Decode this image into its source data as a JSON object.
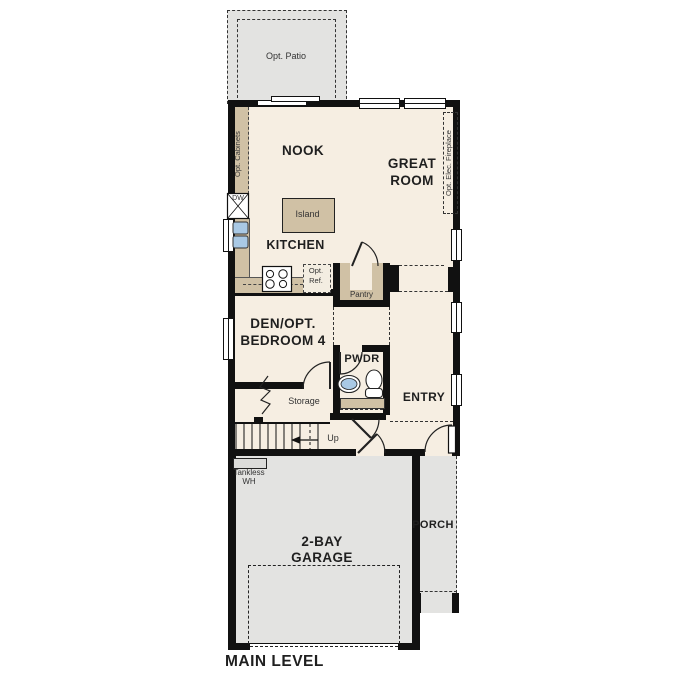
{
  "plan_title": "MAIN LEVEL",
  "rooms": {
    "nook": "NOOK",
    "great_room": [
      "GREAT",
      "ROOM"
    ],
    "kitchen": "KITCHEN",
    "den": [
      "DEN/OPT.",
      "BEDROOM 4"
    ],
    "powder": "PWDR",
    "entry": "ENTRY",
    "storage": "Storage",
    "pantry": "Pantry",
    "garage": [
      "2-BAY",
      "GARAGE"
    ],
    "porch": "PORCH"
  },
  "features": {
    "opt_patio": "Opt. Patio",
    "opt_cabinets": "Opt. Cabinets",
    "opt_elec_fireplace": "Opt. Elec. Fireplace",
    "opt_ref": [
      "Opt.",
      "Ref."
    ],
    "island": "Island",
    "dishwasher": "DW",
    "stairs_up": "Up",
    "tankless_wh": [
      "Tankless",
      "WH"
    ]
  },
  "colors": {
    "wall": "#111111",
    "floor": "#f6eee2",
    "cabinet": "#d0c1a5",
    "outdoor": "#e3e3e1",
    "fixture_blue": "#a9c9e5"
  }
}
